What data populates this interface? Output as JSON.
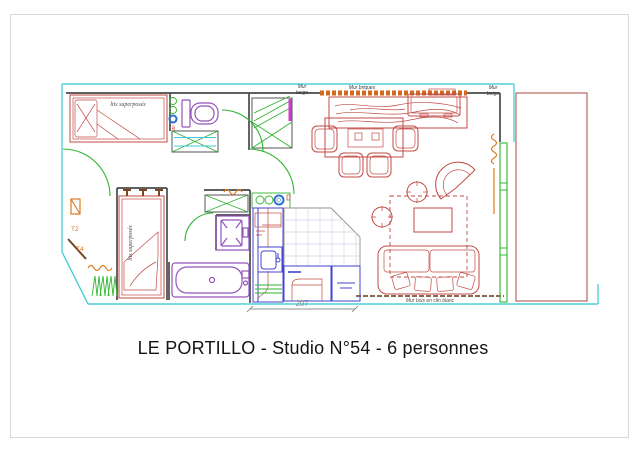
{
  "title": "LE PORTILLO - Studio N°54 - 6 personnes",
  "plan": {
    "labels": {
      "mur_beige_left_line1": "Mur",
      "mur_beige_left_line2": "beige",
      "mur_briques": "Mur briques",
      "mur_beige_right_line1": "Mur",
      "mur_beige_right_line2": "beige",
      "mur_bois": "Mur bois en clin blanc",
      "bunk_bed_top": "lits superposés",
      "bunk_bed_side": "lits superposés",
      "type_t2": "T2",
      "type_t4": "T4",
      "entrance_width_cm": "207",
      "wc_note": "30"
    },
    "palette": {
      "exterior_wall": "#4fd1d6",
      "interior_wall": "#4a4a4a",
      "furniture_red": "#c14b45",
      "sanitary_purple": "#9354bb",
      "kitchen_blue": "#4343cf",
      "doors_windows_green": "#2fb52f",
      "heating_orange": "#e07a1f",
      "brick_orange": "#d2691e",
      "magenta_strip": "#cc3ecc",
      "balcony_red": "#b3584d",
      "dimension_gray": "#8f8f8f",
      "wood_wall_brown": "#8a6a52"
    }
  }
}
